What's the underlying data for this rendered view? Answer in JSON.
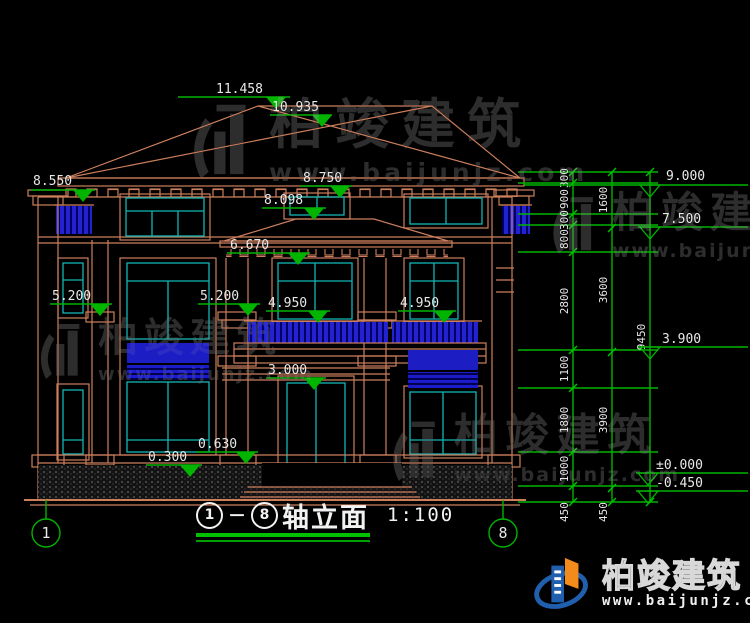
{
  "drawing": {
    "axis": {
      "left": "1",
      "right": "8"
    },
    "title": {
      "axis_start": "1",
      "separator": "－",
      "axis_end": "8",
      "name": "轴立面",
      "scale": "1:100"
    },
    "levels_left": {
      "ridge": "11.458",
      "roof_mid": "10.935",
      "parapet": "8.550",
      "eave": "8.750",
      "win2_top": "8.098",
      "porch_roof": "6.670",
      "lv52a": "5.200",
      "lv52b": "5.200",
      "lv495a": "4.950",
      "lv495b": "4.950",
      "door_top": "3.000",
      "plinth_hi": "0.630",
      "plinth_lo": "0.300"
    },
    "levels_right": {
      "r9": "9.000",
      "r75": "7.500",
      "r39": "3.900",
      "r0": "±0.000",
      "rm045": "-0.450"
    },
    "chain_inner": [
      "300",
      "900",
      "300",
      "800",
      "2800",
      "1100",
      "1800",
      "1000"
    ],
    "chain_mid": [
      "1600",
      "3600",
      "3900"
    ],
    "chain_total": "9450",
    "offsets": [
      "450",
      "450"
    ],
    "watermark": {
      "brand": "柏竣建筑",
      "site": "www.baijunjz.com"
    },
    "logo": {
      "brand": "柏竣建筑",
      "site": "www.baijunjz.com"
    },
    "colors": {
      "structure": "#cd7f5c",
      "glass": "#12b6b6",
      "railing": "#2222d0",
      "dimension": "#00b400",
      "label": "#e8e8e8"
    }
  }
}
